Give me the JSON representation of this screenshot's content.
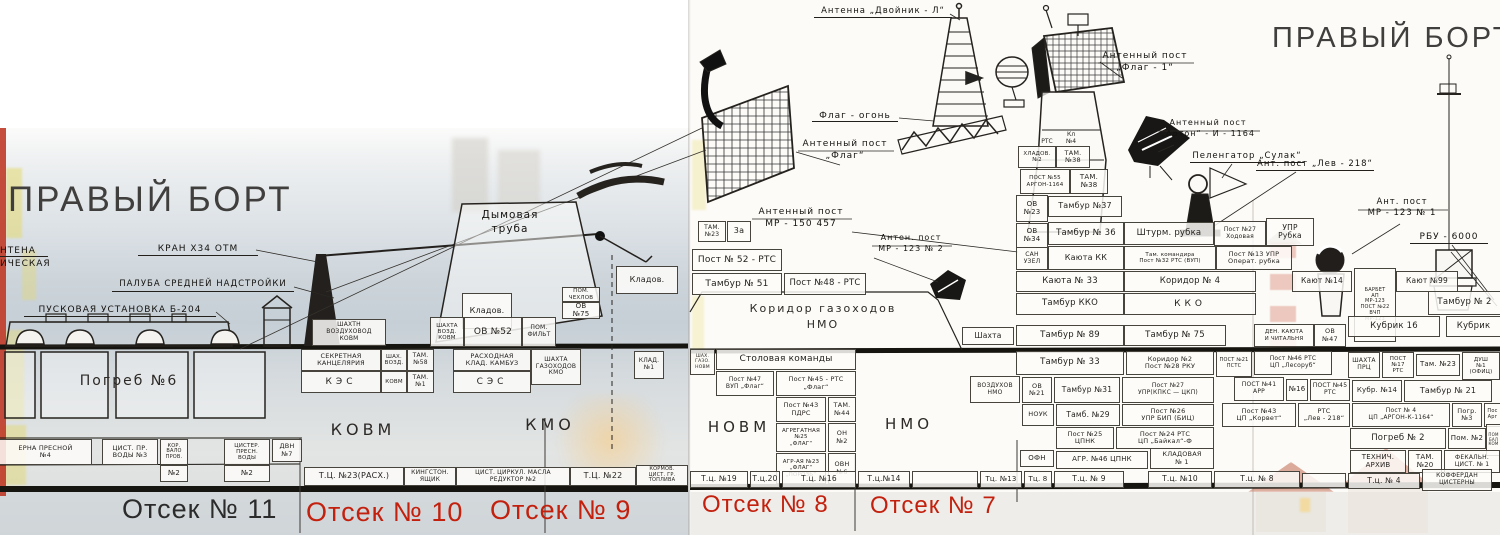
{
  "colors": {
    "accent_red": "#c3200e",
    "ink": "#221f1c",
    "title_gray": "#403f3d"
  },
  "labels": {
    "titles": {
      "left": "ПРАВЫЙ БОРТ",
      "right": "ПРАВЫЙ БОРТ"
    },
    "footer": {
      "o11": "Отсек № 11",
      "o10": "Отсек № 10",
      "o9": "Отсек № 9",
      "o8": "Отсек № 8",
      "o7": "Отсек № 7"
    },
    "callouts": {
      "antenna_cut1": "НТЕНА",
      "antenna_cut2": "ИЧЕСКАЯ",
      "kran": "КРАН  Х34 ОТМ",
      "paluba": "ПАЛУБА  СРЕДНЕЙ  НАДСТРОЙКИ",
      "pusk": "ПУСКОВАЯ  УСТАНОВКА  Б-204",
      "truba": "Дымовая\nтруба",
      "dvoinik": "Антенна  „Двойник - Л“",
      "flag_ogon": "Флаг - огонь",
      "ant_flag": "Антенный  пост\n„Флаг“",
      "ant_flag1": "Антенный  пост\n„Флаг - 1“",
      "ant_arton": "Антенный  пост\n„Артон“ - И - 1164",
      "pelengator": "Пеленгатор „Сулак“",
      "lev218": "Ант. пост „Лев - 218“",
      "mr150": "Антенный  пост\nМР - 150    457",
      "mr123_2": "Антен. пост\nМР - 123  № 2",
      "mr123_1": "Ант. пост\nМР - 123  № 1",
      "rbu": "РБУ - 6000"
    },
    "left": {
      "rooms": {
        "pogreb6": "Погреб №6",
        "kovm": "КОВМ",
        "kmo": "КМО"
      },
      "cells": {
        "klad": "Кладов.",
        "pom_chex": "ПОМ.\nЧЕХЛОВ",
        "ov75": "ОВ\n№75",
        "sh_vozd_kovm": "ШАХТН\nВОЗДУХОВОД\nКОВМ",
        "shaxta_vozd": "ШАХТА\nВОЗД.\nКОВМ",
        "ov52": "ОВ №52",
        "pom_filt": "ПОМ.\nФИЛЬТ",
        "klad_stack": "Кладов.",
        "sekretnaya": "СЕКРЕТНАЯ\nКАНЦЕЛЯРИЯ",
        "kes": "КЭС",
        "shax_vozd2": "ШАХ.\nВОЗД.",
        "kovm_small": "КОВМ",
        "tam58": "ТАМ.\n№58",
        "tam1": "ТАМ.\n№1",
        "rasxodnaya": "РАСХОДНАЯ\nКЛАД. КАМБУЗ",
        "ses": "СЭС",
        "sh_gazoxodov": "ШАХТА\nГАЗОХОДОВ\nКМО",
        "klad_n1": "КЛАД.\n№1"
      },
      "tanks": {
        "cisterna4": "ЕРНА  ПРЕСНОЙ\n№4",
        "cist_pr3": "ЦИСТ. ПР.\nВОДЫ №3",
        "kor_valoprov": "КОР.\nВАЛО\nПРОВ.",
        "n2a": "№2",
        "cister_presn": "ЦИСТЕР.\nПРЕСН.\nВОДЫ",
        "n2b": "№2",
        "dvn7": "ДВН\n№7",
        "tc23": "Т.Ц. №23(РАСХ.)",
        "kingston": "КИНГСТОН.\nЯЩИК",
        "cist_cirkul": "ЦИСТ. ЦИРКУЛ. МАСЛА\nРЕДУКТОР №2",
        "tc22": "Т.Ц. №22",
        "kormov": "КОРМОВ.\nЦИСТ. ГР.\nТОПЛИВА"
      }
    },
    "right": {
      "rooms": {
        "kor_gaz": "Коридор   газоходов\nНМО",
        "novm": "НОВМ",
        "nmo": "НМО"
      },
      "cells": {
        "tam23a": "ТАМ.\n№23",
        "cell3a": "3а",
        "post52": "Пост № 52 - РТС",
        "tambur51": "Тамбур № 51",
        "post48": "Пост №48 - РТС",
        "rtc": "РТС",
        "kl4": "Кл\n№4",
        "xladov2": "ХЛАДОВ.\n№2",
        "tam38a": "ТАМ.\n№38",
        "post55": "ПОСТ №55\nАРГОН-1164",
        "tam38b": "ТАМ.\n№38",
        "ov23": "ОВ\n№23",
        "tambur37": "Тамбур №37",
        "ov34": "ОВ\n№34",
        "tambur36": "Тамбур № 36",
        "shturm": "Штурм. рубка",
        "post27x": "Пост №27\nХодовая",
        "upr_rubka": "УПР\nРубка",
        "san_uzel": "САН\nУЗЕЛ",
        "kayuta_kk": "Каюта КК",
        "tam_komandira": "Там. командира\nПост №32 РТС (ВУП)",
        "post13": "Пост №13 УПР\nОперат. рубка",
        "kayuta33": "Каюта № 33",
        "koridor4": "Коридор № 4",
        "kayut14": "Кают №14",
        "kayut99": "Кают №99",
        "barbet": "БАРБЕТ\nАП\nМР-123\nПОСТ №22\nВЧП\nМР-123",
        "tambur_kko": "Тамбур ККО",
        "kko": "ККО",
        "tambur2": "Тамбур № 2",
        "shaxta": "Шахта",
        "tambur89": "Тамбур № 89",
        "tambur75": "Тамбур № 75",
        "den_kayuta": "ДЕН. КАЮТА\nИ ЧИТАЛЬНЯ",
        "ov47": "ОВ\n№47",
        "kubrik16": "Кубрик 16",
        "kubrik": "Кубрик",
        "shax_gazo_novm": "ШАХ.\nГАЗО.\nНОВМ",
        "stolovaya": "Столовая команды",
        "post47": "Пост №47\nВУП „Флаг“",
        "post45": "Пост №45 - РТС\n„Флаг“",
        "post43p": "Пост №43\nПДРС",
        "tam44": "ТАМ.\n№44",
        "agreg25": "АГРЕГАТНАЯ\n№25\n„ФЛАГ“",
        "on2": "ОН\n№2",
        "agr23": "АГР-АЯ №23\n„ФЛАГ“\n„ПОРОЗЬ“",
        "ovn6": "ОВН\n№6",
        "vozduxov": "ВОЗДУХОВ\nНМО",
        "ov21": "ОВ\n№21",
        "tambur31": "Тамбур №31",
        "post27u": "Пост №27\nУПР(КПКС — ЦКП)",
        "tambur33": "Тамбур № 33",
        "koridor2": "Коридор №2\nПост №28  РКУ",
        "post21pstc": "ПОСТ №21\nПСТС",
        "post46les": "Пост №46 РТС\nЦП „Лесоруб“",
        "prc": "ШАХТА\nПРЦ",
        "post17": "ПОСТ №17\nРТС",
        "tam23b": "Там. №23",
        "dush1": "ДУШ\n№1\n(ОФИЦ)",
        "post41arr": "ПОСТ №41\nАРР",
        "n16": "№16",
        "post45rtc": "ПОСТ №45\nРТС",
        "kubr14": "Кубр. №14",
        "tambur21": "Тамбур № 21",
        "nouk": "НОУК",
        "tamb29": "Тамб. №29",
        "post26": "Пост №26\nУПР БИП (БИЦ)",
        "post43korvet": "Пост №43\nЦП „Корвет“",
        "rtc_lev": "РТС\n„Лев - 218“",
        "post4argon": "Пост № 4\nЦП „АРГОН-К-1164“",
        "pogr3": "Погр.\n№3",
        "post_argon_cut": "Пос\nАрг",
        "post25": "Пост №25\nЦПНК",
        "post24": "Пост №24 РТС\nЦП „Байкал“-Ф",
        "ofn": "ОФН",
        "agr46": "АГР. №46  ЦПНК",
        "kladovaya1": "КЛАДОВАЯ\n№ 1",
        "pogreb2": "Погреб № 2",
        "pom2": "Пом. №2",
        "pom_balon": "ПОМ\nБАЛ\nКОМ",
        "tex_arhiv": "ТЕХНИЧ.\nАРХИВ",
        "tam20": "ТАМ.\n№20",
        "fekal": "ФЕКАЛЬН.\nЦИСТ. № 1"
      },
      "tanks": {
        "tc19": "Т.ц. №19",
        "tc20": "Т.ц.20",
        "tc16": "Т.ц. №16",
        "tc14": "Т.ц.№14",
        "empty1": "",
        "tc13": "Тц. №13",
        "tc8a": "Тц. 8",
        "tc9": "Т.ц. № 9",
        "tc10": "Т.ц. №10",
        "tc8b": "Т.ц. № 8",
        "empty2": "",
        "tc4": "Т.ц. № 4",
        "kofferdan": "КОФФЕРДАН\nЦИСТЕРНЫ"
      }
    }
  }
}
